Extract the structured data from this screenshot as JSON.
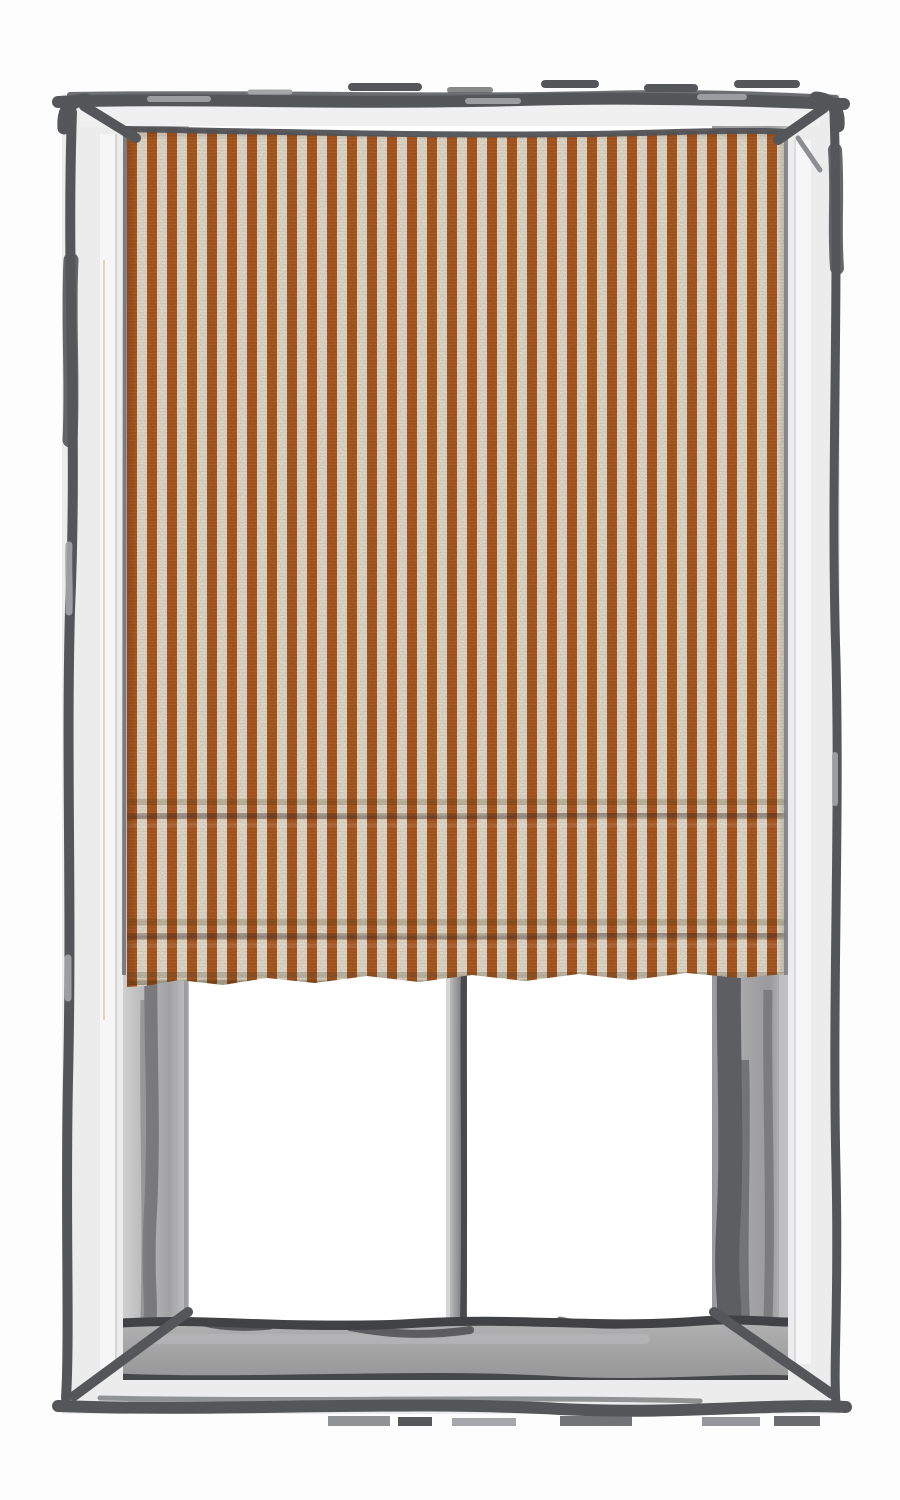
{
  "scene": {
    "type": "illustration",
    "subject": "window with striped roman shade",
    "style": "hand-drawn sketched window frame, fabric shade lowered about two-thirds",
    "shade": {
      "kind": "roman-shade",
      "state": "partially lowered",
      "pattern": "vertical ticking stripes",
      "stripe_colors": [
        "rust-orange",
        "linen-cream"
      ],
      "first_stripe": "orange",
      "visible_fold_shadows": 2
    },
    "window": {
      "pane_count": 2,
      "divider": "single vertical center mullion",
      "sill": "visible gray inner sill",
      "glass": "blank white"
    }
  },
  "palette": {
    "page_bg": "#fdfdfd",
    "outline_dark": "#55565a",
    "frame_face": "#ececec",
    "frame_face_bright": "#f7f7f8",
    "jamb_gray": "#a9a9aa",
    "jamb_gray_dark": "#646568",
    "sill_gray": "#a4a4a5",
    "sill_edge_dark": "#414245",
    "pane_white": "#ffffff",
    "stripe_orange": "#b15a1e",
    "stripe_cream": "#ebe7da",
    "fold_shadow": "#3c2c1c",
    "warm_hairline": "#d9a07a"
  },
  "shade_metrics": {
    "stripe_period_px": 20,
    "stripe_orange_px": 10
  }
}
